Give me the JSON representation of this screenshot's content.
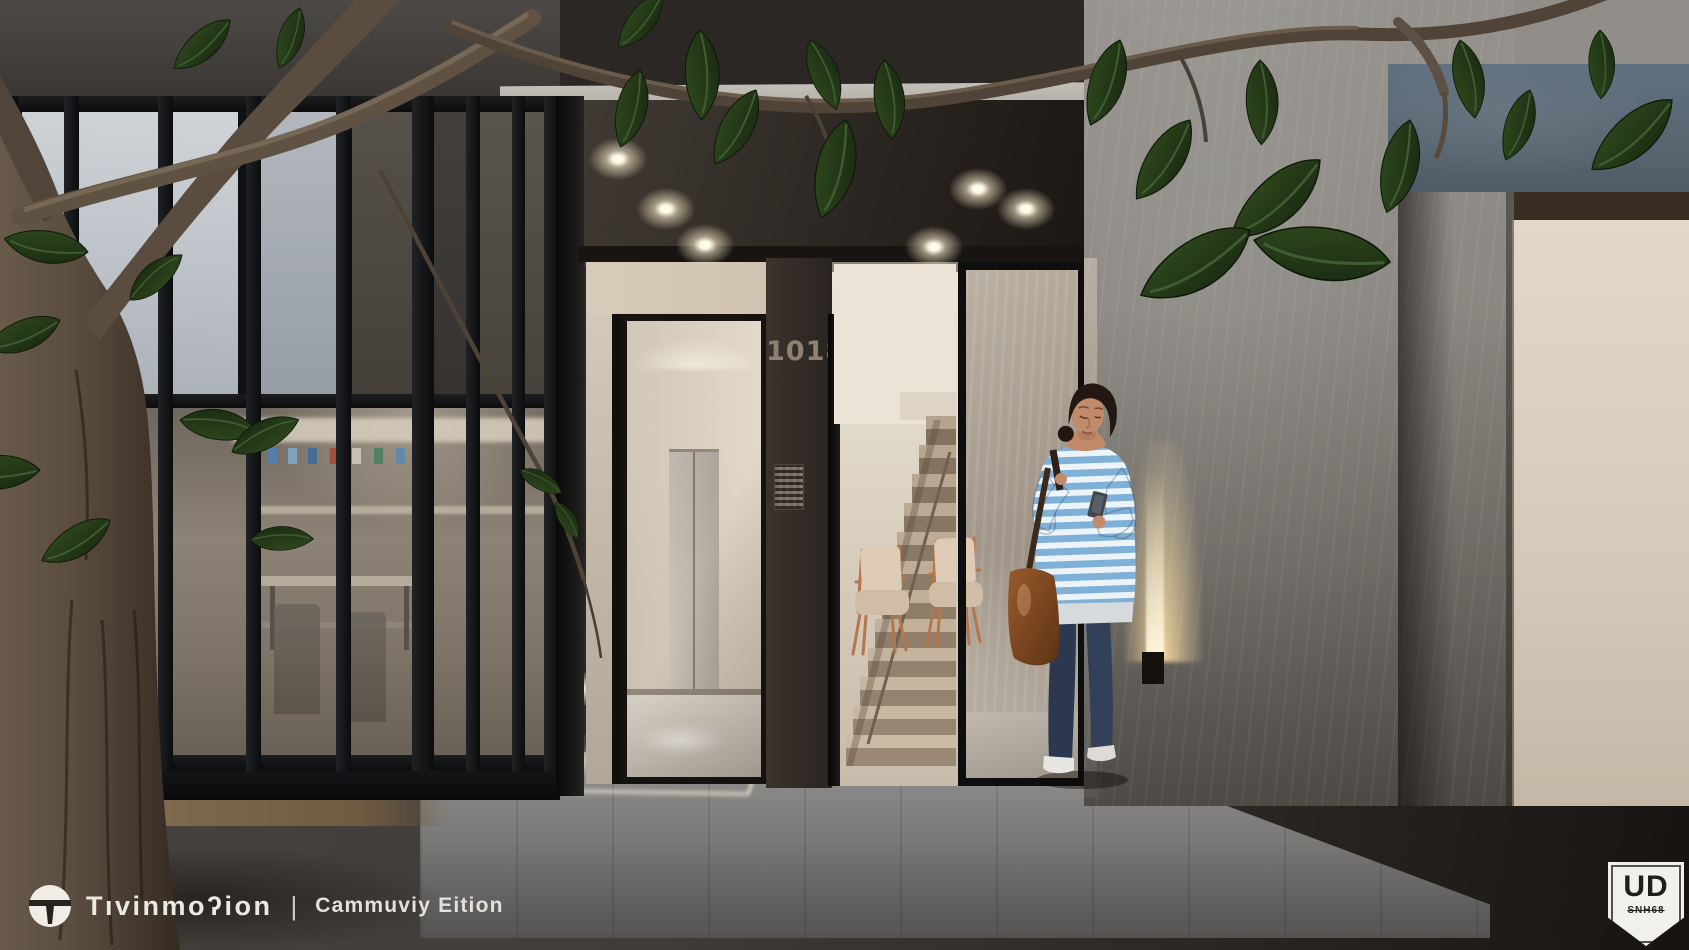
{
  "entrance": {
    "door_number": "1018"
  },
  "watermark": {
    "logo": "Tıvinmoʔion",
    "separator": "|",
    "edition": "Cammuviy Eition"
  },
  "badge": {
    "title": "UD",
    "subtitle": "SNH68"
  },
  "palette": {
    "canopy": "#26221e",
    "fascia": "#b5b1ab",
    "mullion": "#141618",
    "glass_pale": "#c3c8cd",
    "store_warm": "#877b6e",
    "pillar": "#332d27",
    "door_number": "#8e8173",
    "lobby_wall": "#e4dac9",
    "stair": "#c0ae97",
    "concrete": "#8e8b86",
    "cream": "#d9cfc0",
    "blue_band": "#5e6d7c",
    "brown_band": "#3a2d24",
    "marble": "#7e7c79",
    "pavement": "#3b3835",
    "trunk": "#574a3d",
    "leaf": "#22361a",
    "stripe_blue": "#7fb0d8",
    "stripe_white": "#ecf3f9",
    "jeans": "#2b3850",
    "bag": "#8a4f27",
    "skin": "#c18a6b",
    "hair": "#221811",
    "sconce": "#f3dcad",
    "bronze": "#8d7557",
    "watermark_text": "#ece9e3",
    "badge_bg": "#f2f0ec",
    "badge_text": "#201e1b"
  }
}
